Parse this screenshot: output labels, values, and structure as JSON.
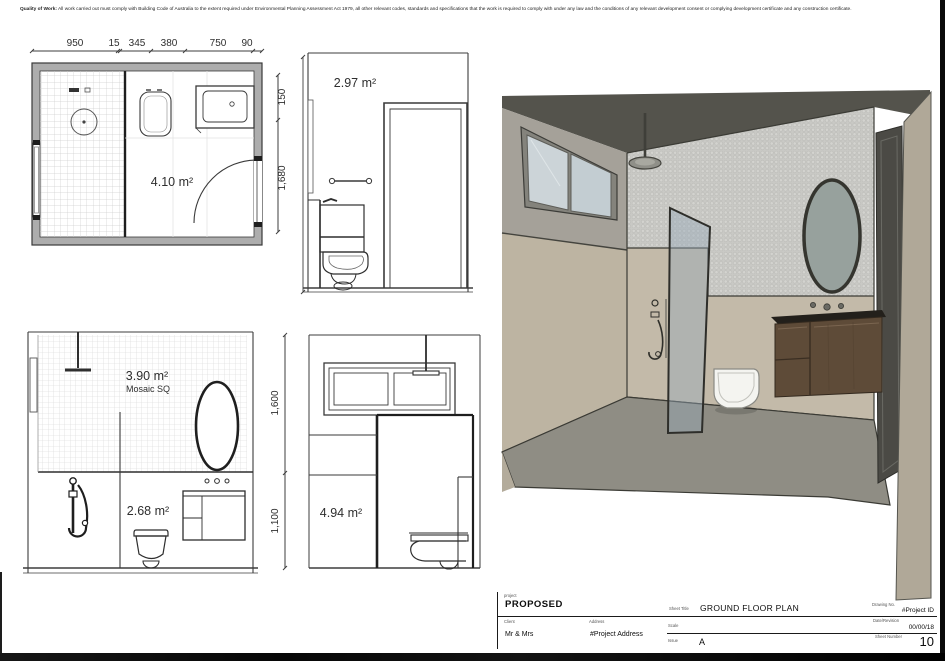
{
  "disclaimer": {
    "bold_prefix": "Quality of Work:",
    "text": "All work carried out must comply with Building Code of Australia to the extent required under Environmental Planning Assessment Act 1979, all other relevant codes, standards and specifications that the work is required to comply with under any law and the conditions of any relevant development consent or complying development certificate and any construction certificate."
  },
  "floor_plan": {
    "top_dims": [
      "950",
      "15",
      "345",
      "380",
      "750",
      "90"
    ],
    "right_dims": [
      "150",
      "1,680"
    ],
    "area": "4.10 m²"
  },
  "elevation_toilet_wall": {
    "area": "2.97 m²"
  },
  "elevation_shower_wall": {
    "wall_area": "3.90 m²",
    "finish": "Mosaic SQ",
    "area": "2.68 m²"
  },
  "elevation_window_wall": {
    "left_dims": [
      "1,600",
      "1,100"
    ],
    "area": "4.94 m²"
  },
  "render": {
    "description": "3D perspective of proposed bathroom",
    "colors": {
      "ceiling": "#54534c",
      "wall_upper": "#a5a199",
      "wall_lower": "#bdb4a2",
      "mosaic_tile": "#c9c9c5",
      "floor": "#8f8d84",
      "vanity_wood": "#5e4b38",
      "glass_screen": "#96aab9",
      "mirror_glass": "#97a19d",
      "door": "#4b4a45",
      "window_glass": "#ccd4d8"
    }
  },
  "title_block": {
    "project_label": "project",
    "project_value": "PROPOSED",
    "client_label": "Client",
    "client_value": "Mr & Mrs",
    "address_label": "Address",
    "address_value": "#Project Address",
    "sheet_title_label": "Sheet Title",
    "sheet_title_value": "GROUND FLOOR PLAN",
    "scale_label": "Scale",
    "scale_value": "",
    "issue_label": "Issue",
    "issue_value": "A",
    "drawing_no_label": "Drawing No.",
    "drawing_no_value": "#Project ID",
    "date_revision_label": "Date/Revision",
    "date_revision_value": "00/00/18",
    "sheet_number_label": "Sheet Number",
    "sheet_number_value": "10"
  }
}
